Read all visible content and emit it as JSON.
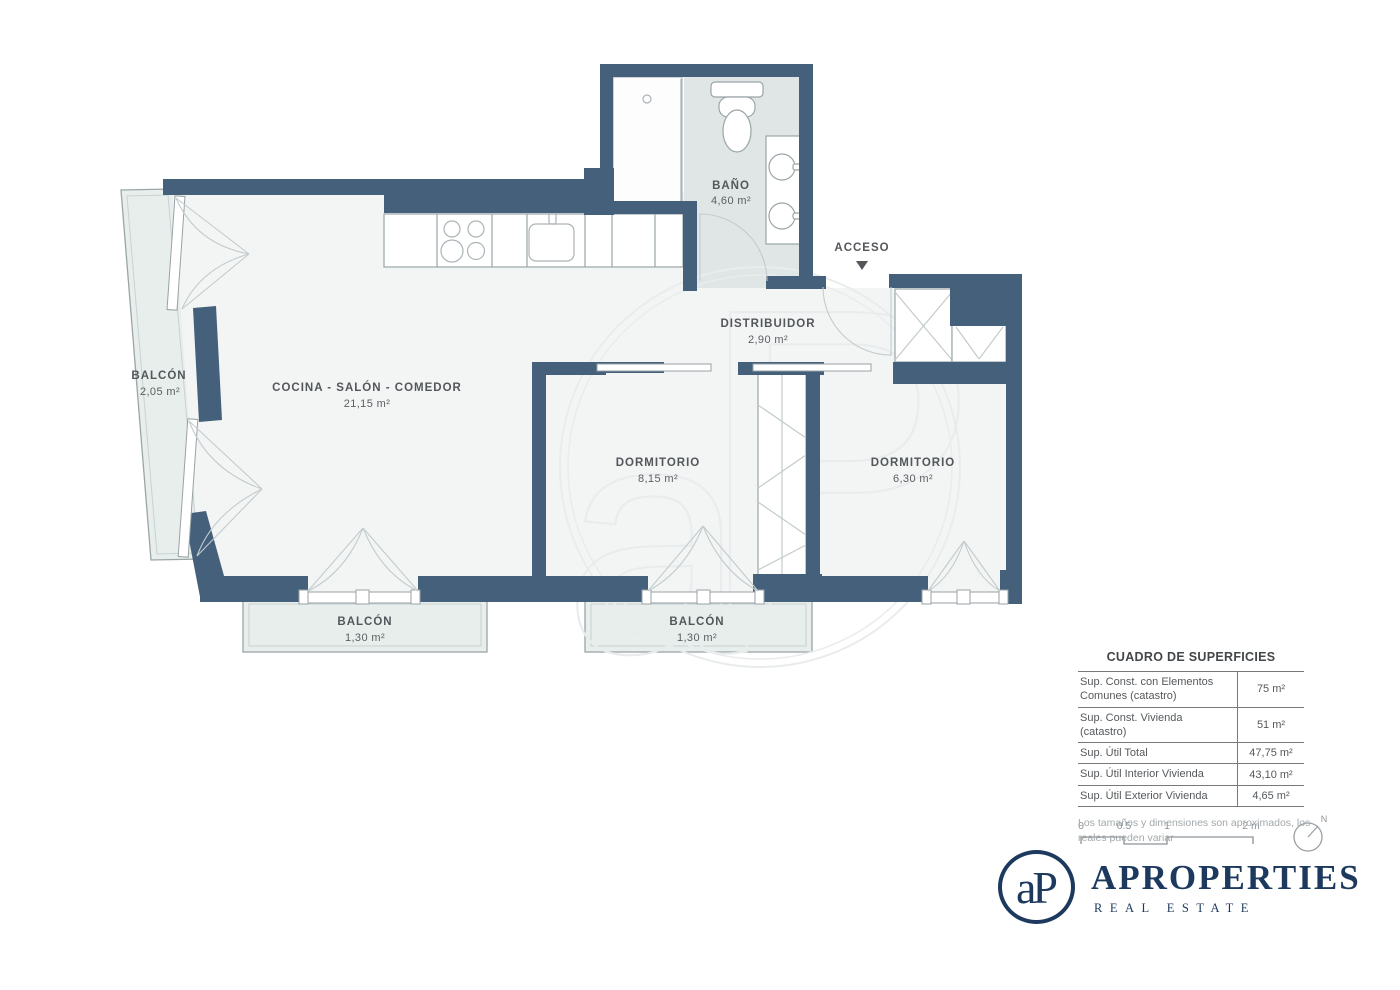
{
  "plan": {
    "access_label": "ACCESO",
    "rooms": {
      "bano": {
        "name": "BAÑO",
        "area": "4,60 m²"
      },
      "salon": {
        "name": "COCINA - SALÓN - COMEDOR",
        "area": "21,15 m²"
      },
      "balcon_izq": {
        "name": "BALCÓN",
        "area": "2,05 m²"
      },
      "distribuidor": {
        "name": "DISTRIBUIDOR",
        "area": "2,90 m²"
      },
      "dormitorio1": {
        "name": "DORMITORIO",
        "area": "8,15 m²"
      },
      "dormitorio2": {
        "name": "DORMITORIO",
        "area": "6,30 m²"
      },
      "balcon1": {
        "name": "BALCÓN",
        "area": "1,30 m²"
      },
      "balcon2": {
        "name": "BALCÓN",
        "area": "1,30 m²"
      }
    }
  },
  "surface_table": {
    "title": "CUADRO DE SUPERFICIES",
    "rows": [
      {
        "label": "Sup. Const. con Elementos Comunes (catastro)",
        "value": "75 m²"
      },
      {
        "label": "Sup. Const. Vivienda (catastro)",
        "value": "51 m²"
      },
      {
        "label": "Sup. Útil Total",
        "value": "47,75 m²"
      },
      {
        "label": "Sup. Útil Interior Vivienda",
        "value": "43,10 m²"
      },
      {
        "label": "Sup. Útil Exterior Vivienda",
        "value": "4,65 m²"
      }
    ],
    "note": "Los tamaños y dimensiones son aproximados, los reales pueden variar"
  },
  "scale_bar": {
    "ticks": [
      "0",
      "0.5",
      "1",
      "2 m"
    ]
  },
  "compass": {
    "north_label": "N"
  },
  "brand": {
    "monogram": "aP",
    "name": "APROPERTIES",
    "tagline": "REAL ESTATE"
  },
  "colors": {
    "wall": "#45607a",
    "room": "#f3f5f5",
    "bath": "#e0e6e6",
    "balcony": "#e8eeec",
    "brand_navy": "#1d3a5e",
    "label_gray": "#53575b"
  }
}
